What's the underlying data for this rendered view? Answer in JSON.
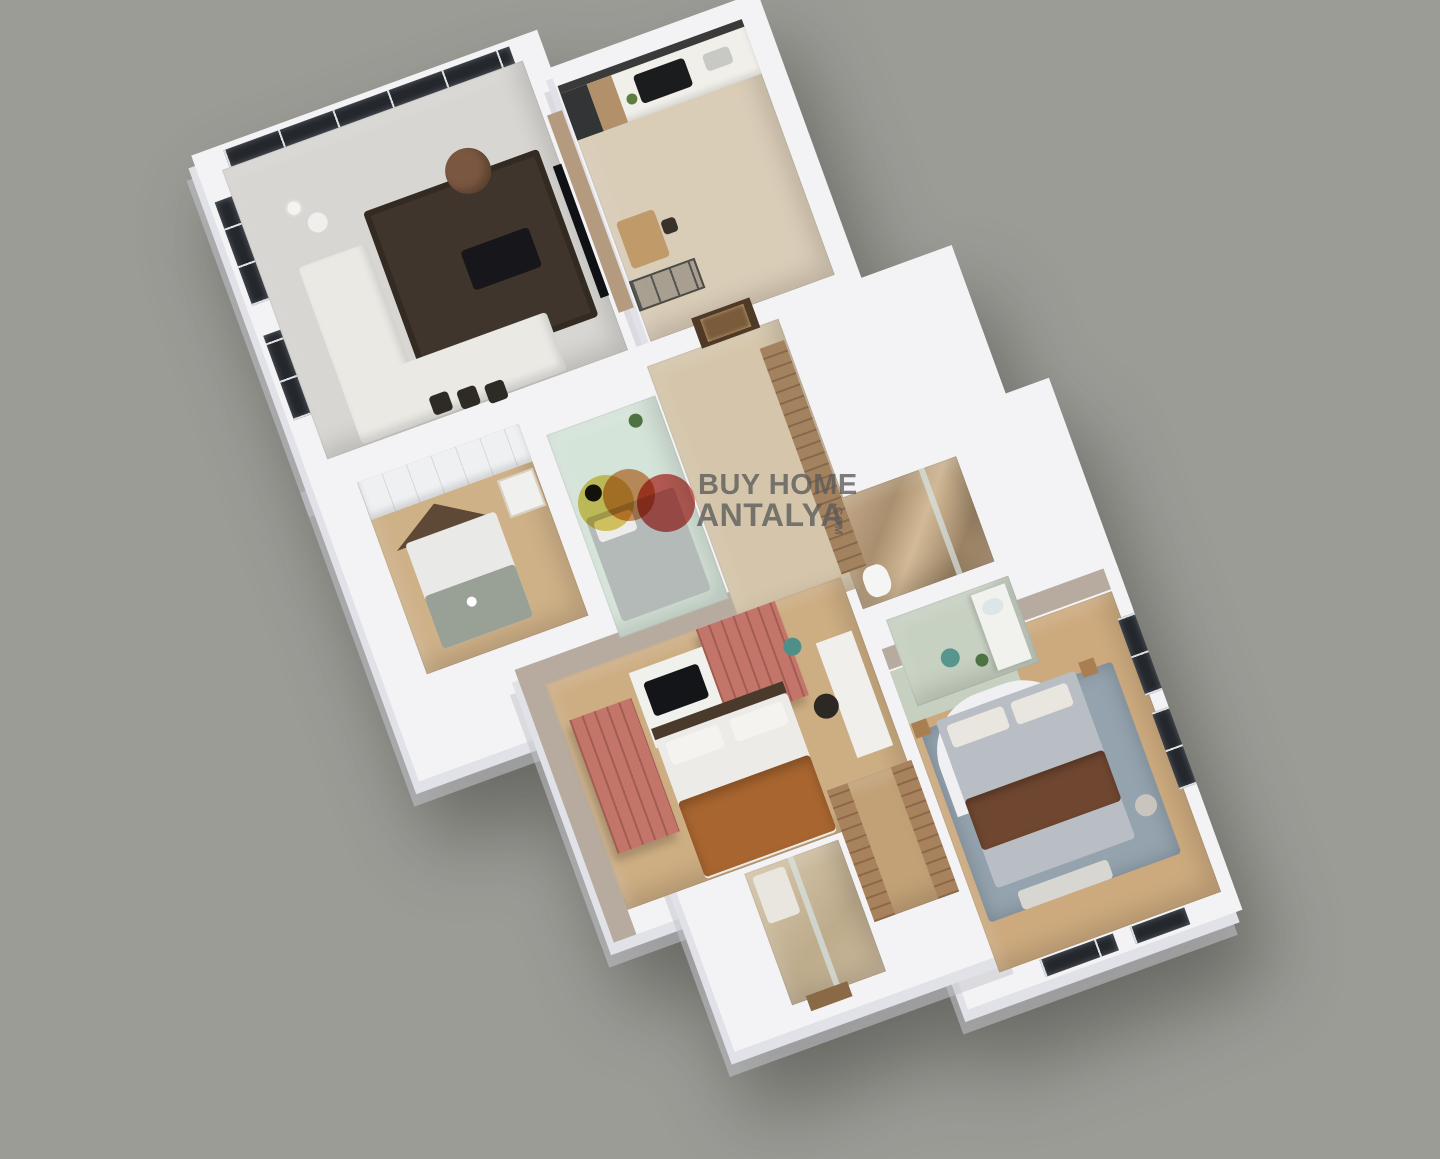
{
  "scene": {
    "title": "3D apartment floor plan render",
    "background_color": "#9b9c96",
    "wall_color": "#f3f3f5",
    "accent_wall_color": "#b7aa9f",
    "terracotta_color": "#c4756a",
    "mint_color": "#d5e4d9",
    "rug_blue_color": "#94a3ae"
  },
  "watermark": {
    "line1": "BUY HOME",
    "line2": "ANTALYA",
    "suffix": ".COM",
    "text_color": "#5a5a5a",
    "logo_circles": [
      {
        "name": "yellow-circle",
        "color": "#ddca55"
      },
      {
        "name": "orange-circle",
        "color": "#d58a52"
      },
      {
        "name": "red-circle",
        "color": "#cc4843"
      }
    ]
  },
  "rooms": [
    {
      "name": "living-room",
      "floor_color": "#d8d6d2",
      "furniture": [
        "corner-sofa",
        "coffee-table",
        "dark-area-rug",
        "tv-panel-wall",
        "floor-lamp",
        "round-pouf",
        "dining-chairs",
        "floor-to-ceiling-windows"
      ]
    },
    {
      "name": "kitchen",
      "floor_color": "#dacdb8",
      "furniture": [
        "counter",
        "cooktop",
        "sink",
        "tall-cabinet",
        "breakfast-table",
        "glass-partition-door"
      ]
    },
    {
      "name": "entry-hall",
      "floor_color": "#d5c6ab",
      "furniture": [
        "entrance-door",
        "hall-wardrobe"
      ]
    },
    {
      "name": "kids-bedroom",
      "floor_color": "#cfb188",
      "furniture": [
        "house-frame-bed",
        "white-wardrobe",
        "shelf"
      ]
    },
    {
      "name": "mint-bedroom",
      "floor_color": "#d5e4d9",
      "furniture": [
        "daybed",
        "black-side-table",
        "plant"
      ]
    },
    {
      "name": "marble-bathroom",
      "floor_color": "#b59a7c",
      "furniture": [
        "toilet",
        "glass-shower-panel"
      ]
    },
    {
      "name": "vanity-bathroom",
      "floor_color": "#c7d1c2",
      "furniture": [
        "vanity-counter",
        "mirror",
        "teal-stool",
        "plant"
      ]
    },
    {
      "name": "terracotta-bedroom",
      "floor_color": "#cdad82",
      "furniture": [
        "terracotta-wardrobe-left",
        "terracotta-wardrobe-right",
        "tv-unit",
        "double-bed-orange-blanket",
        "desk",
        "chair",
        "teal-pouf"
      ]
    },
    {
      "name": "master-bedroom",
      "floor_color": "#cdaa7e",
      "furniture": [
        "double-bed",
        "curved-headboard",
        "brown-throw",
        "blue-gray-rug",
        "bench",
        "side-tables",
        "vanity-tile-wall",
        "windows"
      ]
    },
    {
      "name": "shower-room",
      "floor_color": "#cbb99e",
      "furniture": [
        "glass-shower-panel",
        "door"
      ]
    },
    {
      "name": "walk-in-closet",
      "floor_color": "#c2a176",
      "furniture": [
        "wardrobe-left",
        "wardrobe-right"
      ]
    }
  ]
}
